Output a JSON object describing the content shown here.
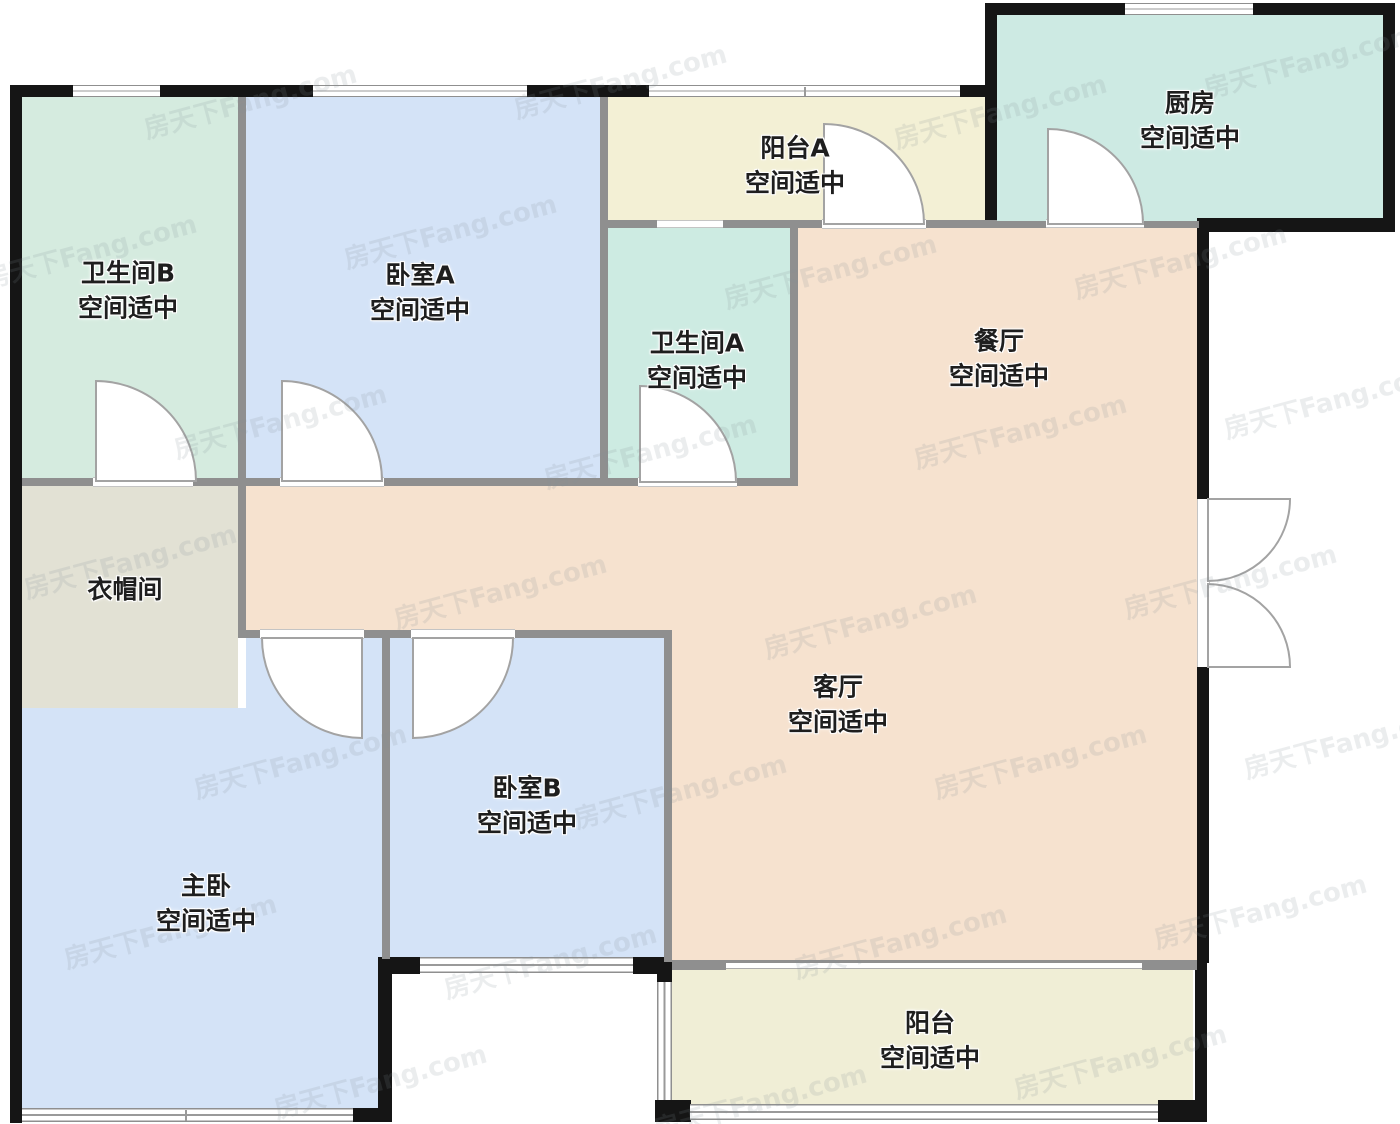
{
  "watermark_text": "房天下Fang.com",
  "plan": {
    "rooms": [
      {
        "id": "bathroom-b",
        "name": "卫生间B",
        "status": "空间适中",
        "color": "#d5ebdf"
      },
      {
        "id": "bedroom-a",
        "name": "卧室A",
        "status": "空间适中",
        "color": "#d4e3f7"
      },
      {
        "id": "balcony-a",
        "name": "阳台A",
        "status": "空间适中",
        "color": "#f3f0d5"
      },
      {
        "id": "kitchen",
        "name": "厨房",
        "status": "空间适中",
        "color": "#cdeae3"
      },
      {
        "id": "bathroom-a",
        "name": "卫生间A",
        "status": "空间适中",
        "color": "#cdebe2"
      },
      {
        "id": "dining-room",
        "name": "餐厅",
        "status": "空间适中",
        "color": "#f6e2cf"
      },
      {
        "id": "cloakroom",
        "name": "衣帽间",
        "status": "",
        "color": "#e2e1d4"
      },
      {
        "id": "living-room",
        "name": "客厅",
        "status": "空间适中",
        "color": "#f6e2cf"
      },
      {
        "id": "master-bedroom",
        "name": "主卧",
        "status": "空间适中",
        "color": "#d4e3f7"
      },
      {
        "id": "bedroom-b",
        "name": "卧室B",
        "status": "空间适中",
        "color": "#d4e3f7"
      },
      {
        "id": "balcony",
        "name": "阳台",
        "status": "空间适中",
        "color": "#f0eed6"
      }
    ]
  }
}
